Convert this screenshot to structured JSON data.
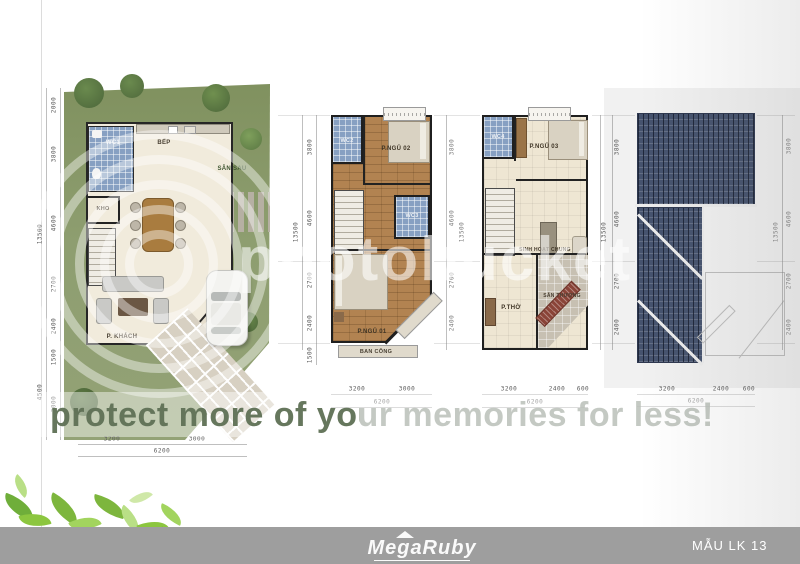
{
  "footer": {
    "brand_logo": "MegaRuby",
    "model_label": "MẪU LK 13"
  },
  "watermark": {
    "brand": "photobucket",
    "tagline": "protect more of your memories for less!"
  },
  "plans": [
    {
      "id": "ground-floor",
      "rooms": {
        "wc1": "WC1",
        "bep": "BẾP",
        "san_sau": "SÂN SAU",
        "kho": "KHO",
        "p_khach": "P. KHÁCH",
        "hien": "HIÊN"
      },
      "dims_left": [
        "2000",
        "3800",
        "4600",
        "2700",
        "2400",
        "1500",
        "3000"
      ],
      "dims_left_total": "13500",
      "dims_front_total": "4500",
      "dims_bottom": [
        "3200",
        "3000"
      ],
      "dims_bottom_total": "6200"
    },
    {
      "id": "second-floor",
      "rooms": {
        "wc2": "WC2",
        "p_ngu_02": "P.NGỦ 02",
        "wc3": "WC3",
        "p_ngu_01": "P.NGỦ 01",
        "ban_cong": "BAN CÔNG"
      },
      "dims_left": [
        "3800",
        "4600",
        "2700",
        "2400",
        "1500"
      ],
      "dims_left_total": "13500",
      "dims_right": [
        "3800",
        "4600",
        "2700",
        "2400"
      ],
      "dims_right_total": "13500",
      "dims_bottom": [
        "3200",
        "3000"
      ],
      "dims_bottom_total": "6200"
    },
    {
      "id": "third-floor",
      "rooms": {
        "wc4": "WC4",
        "p_ngu_03": "P.NGỦ 03",
        "sinh_hoat_chung": "SINH HOẠT CHUNG",
        "p_tho": "P.THỜ",
        "san_thuong": "SÂN THƯỢNG"
      },
      "dims_right": [
        "3800",
        "4600",
        "2700",
        "2400"
      ],
      "dims_right_total": "13500",
      "dims_bottom": [
        "3200",
        "2400",
        "600"
      ],
      "dims_bottom_total": "6200"
    },
    {
      "id": "roof",
      "dims_right": [
        "3800",
        "4600",
        "2700",
        "2400"
      ],
      "dims_right_total": "13500",
      "dims_bottom": [
        "3200",
        "2400",
        "600"
      ],
      "dims_bottom_total": "6200"
    }
  ],
  "colors": {
    "footer_bar": "#9e9e9e",
    "lot_green": "#8e9e70",
    "roof_navy": "#46536e",
    "wood_floor": "#b28351",
    "wc_tile_blue": "#87a0c2",
    "leaf_green": "#8cc63f"
  }
}
